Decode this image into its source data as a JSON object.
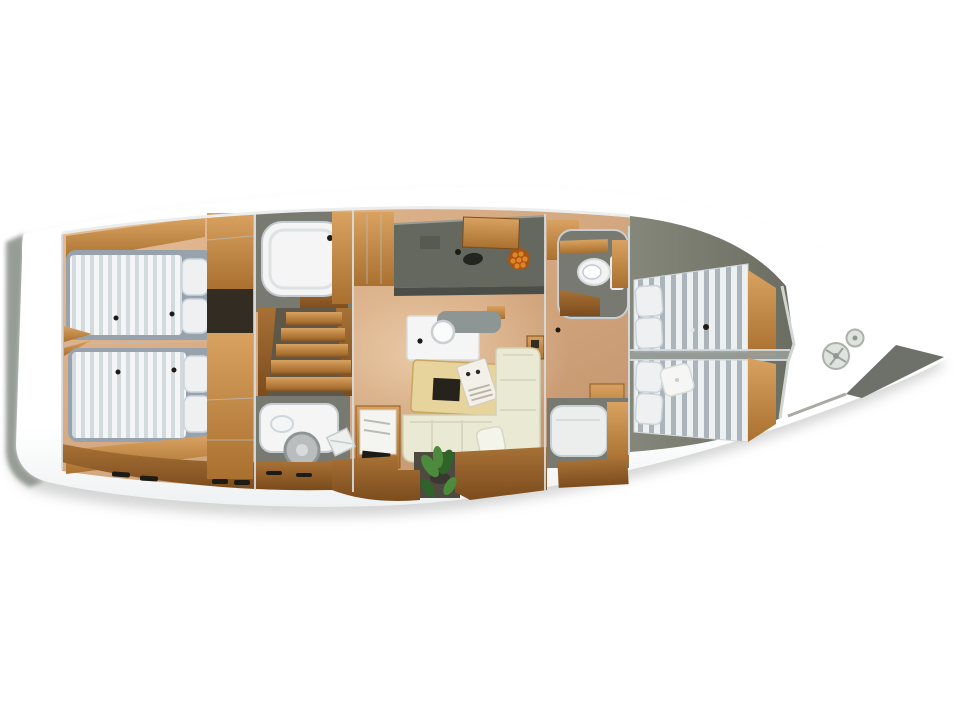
{
  "meta": {
    "title": "Sailing yacht interior layout — top-down 3D rendering",
    "orientation": "bow pointing right, stern left",
    "background": "plain white"
  },
  "regions": [
    {
      "name": "aft-cabin-port",
      "contents": [
        "double-berth-striped-mattress",
        "pillows",
        "wood-trim",
        "drawer-cabinet"
      ]
    },
    {
      "name": "aft-cabin-starboard",
      "contents": [
        "double-berth-striped-mattress",
        "pillows",
        "wood-trim",
        "drawer-cabinet"
      ]
    },
    {
      "name": "shower-room",
      "contents": [
        "white-shower-tub",
        "teak-floor"
      ]
    },
    {
      "name": "companionway-stairs",
      "contents": [
        "five-wood-treads"
      ]
    },
    {
      "name": "aft-head",
      "contents": [
        "white-vanity",
        "round-hatch-disc",
        "drawer-front"
      ]
    },
    {
      "name": "galley",
      "contents": [
        "dark-counter",
        "sink",
        "faucet",
        "fruit-bowl-oranges",
        "wood-lockers"
      ]
    },
    {
      "name": "salon",
      "contents": [
        "chart-table",
        "gray-bench",
        "round-stool",
        "dining-table",
        "magazine",
        "l-shaped-sofa",
        "corner-cushion",
        "plant",
        "nav-desk-with-papers",
        "keyboard",
        "floor-chart"
      ]
    },
    {
      "name": "forward-head",
      "contents": [
        "toilet",
        "wood-vanity",
        "teak-floor"
      ]
    },
    {
      "name": "forward-single-berth",
      "contents": [
        "white-mattress",
        "wood-cabinet"
      ]
    },
    {
      "name": "forward-cabin-port",
      "contents": [
        "striped-berth",
        "pillows",
        "wardrobe"
      ]
    },
    {
      "name": "forward-cabin-starboard",
      "contents": [
        "striped-berth",
        "pillows",
        "white-cushion",
        "wardrobe"
      ]
    },
    {
      "name": "bow-deck",
      "contents": [
        "windlass-disc-large",
        "windlass-disc-small",
        "anchor-channel"
      ]
    }
  ],
  "colors": {
    "hull": "#ffffff",
    "hullEdge": "#eef1f2",
    "hullSide": "#8e948e",
    "shadow": "#c6c8c6",
    "salonFloorA": "#e5bd96",
    "salonFloorB": "#c2926a",
    "fwdFloorA": "#85877b",
    "fwdFloorB": "#6b6d62",
    "woodLight": "#d9a260",
    "woodMid": "#a9702f",
    "woodFloorA": "#a77136",
    "woodFloorB": "#7c4c1d",
    "counter": "#65685f",
    "counterDark": "#4b4e46",
    "chrome": "#d6dde1",
    "seam": "#b9c0c4",
    "wallGray": "#787a71",
    "bedBase": "#97a2ad",
    "mattress": "#f3f5f6",
    "stripe": "#d3dade",
    "fwdStripeA": "#edf0f1",
    "fwdStripeB": "#aab4ba",
    "pillow": "#eef0f2",
    "pillowEdge": "#ccd4d9",
    "sofa": "#e9e9d4",
    "sofaShade": "#d2d2b6",
    "tableWood": "#e6d49c",
    "tableEdge": "#c8a75e",
    "tableInset": "#26231c",
    "white": "#f4f5f4",
    "toilet": "#f2f4f4",
    "darkGap": "#332c22",
    "plant": "#4c8a3c",
    "plantDark": "#2f6428",
    "orange": "#e08427",
    "orangeDark": "#a85512",
    "glow": "#ffe9c8",
    "black": "#1d1b16"
  }
}
